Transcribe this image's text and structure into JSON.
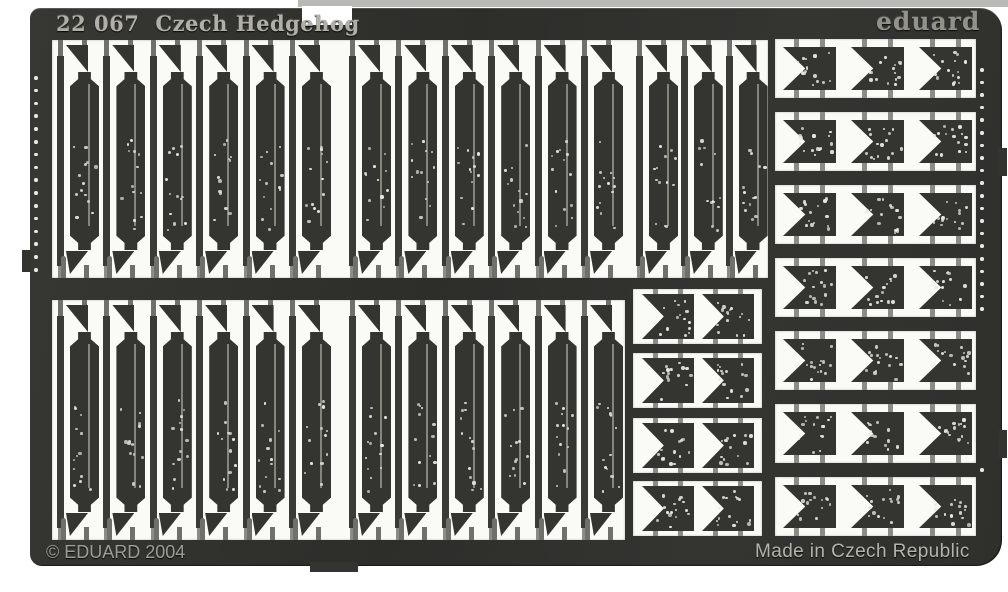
{
  "sheet_scan": {
    "header": {
      "catalog_number": "22 067",
      "product_name": "Czech Hedgehog",
      "brand_logo": "eduard"
    },
    "footer": {
      "copyright": "© EDUARD 2004",
      "origin": "Made in Czech Republic"
    },
    "material_colors": {
      "fret_dark": "#32322f",
      "scan_background": "#ffffff",
      "window_white": "#fafaf7",
      "etched_text_light": "#b0b0a8",
      "brand_text": "#92928b",
      "sprue_tab_gray": "#8c8c86",
      "rivet_dot": "#e8e8e2"
    },
    "part_groups": [
      {
        "id": "top-left",
        "type": "hedgehog-beam-strips",
        "units": 6
      },
      {
        "id": "top-middle",
        "type": "hedgehog-beam-strips",
        "units": 6
      },
      {
        "id": "top-right",
        "type": "hedgehog-beam-strips",
        "units": 3
      },
      {
        "id": "bottom-left",
        "type": "hedgehog-beam-strips",
        "units": 6
      },
      {
        "id": "bottom-middle",
        "type": "hedgehog-beam-strips",
        "units": 6
      },
      {
        "id": "mid-right",
        "type": "notched-bracket-plates",
        "rows": 4,
        "cols": 2
      },
      {
        "id": "right-column",
        "type": "notched-bracket-plates",
        "rows": 7,
        "cols": 3
      }
    ]
  }
}
